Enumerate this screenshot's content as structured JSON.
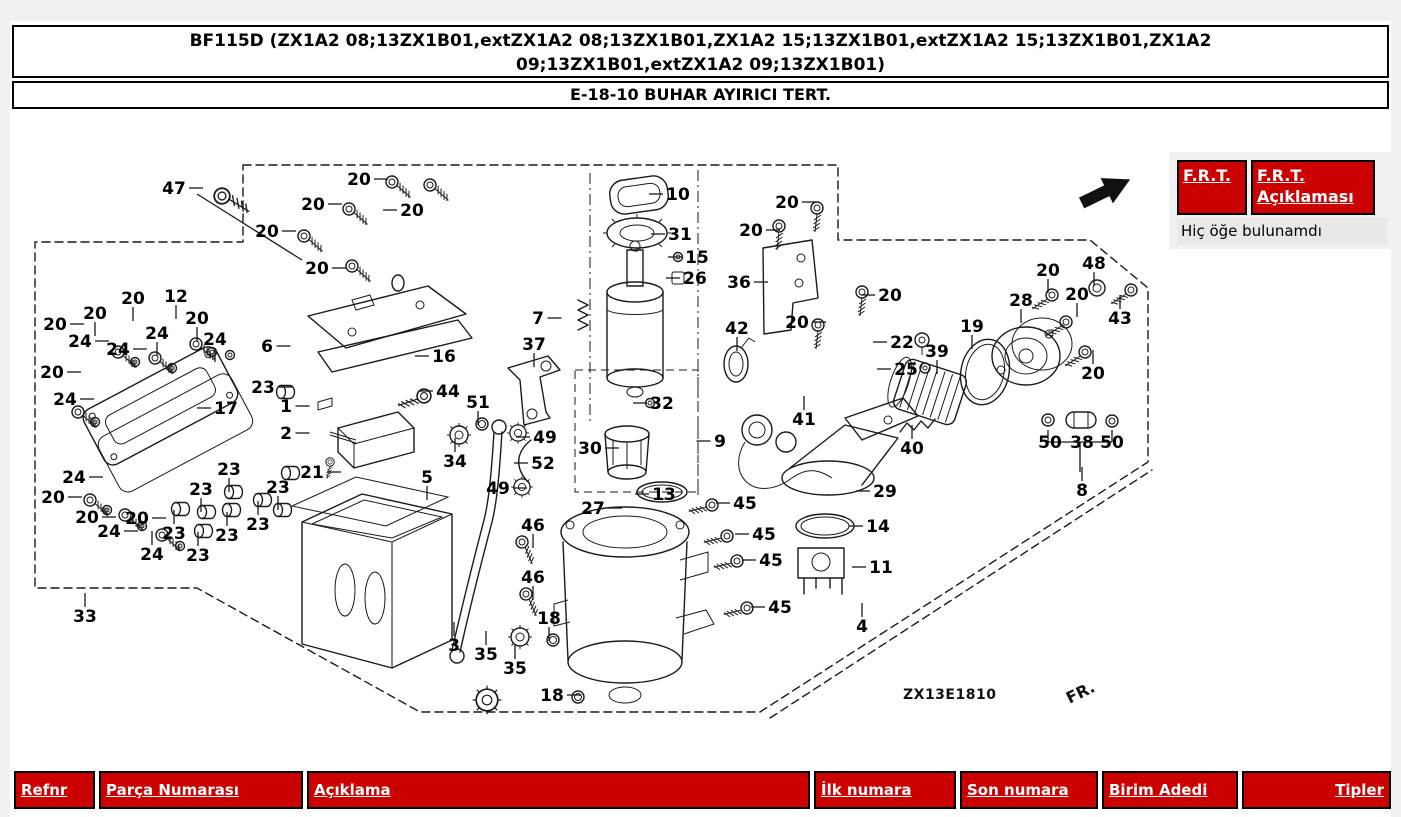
{
  "header": {
    "title_line1": "BF115D (ZX1A2 08;13ZX1B01,extZX1A2 08;13ZX1B01,ZX1A2 15;13ZX1B01,extZX1A2 15;13ZX1B01,ZX1A2",
    "title_line2": "09;13ZX1B01,extZX1A2 09;13ZX1B01)",
    "subtitle": "E-18-10 BUHAR AYIRICI TERT."
  },
  "frt": {
    "button1": "F.R.T.",
    "button2": "F.R.T. Açıklaması",
    "empty_message": "Hiç öğe bulunamdı"
  },
  "colors": {
    "accent_red": "#cc0000",
    "panel_gray": "#f1f1f1",
    "message_gray": "#e8e8e8",
    "ink": "#1a1a1a"
  },
  "diagram": {
    "figure_code": "ZX13E1810",
    "direction_label": "FR.",
    "callouts": [
      {
        "n": "47",
        "x": 174,
        "y": 188,
        "d": "r"
      },
      {
        "n": "20",
        "x": 359,
        "y": 179,
        "d": "r"
      },
      {
        "n": "20",
        "x": 313,
        "y": 204,
        "d": "r"
      },
      {
        "n": "20",
        "x": 267,
        "y": 231,
        "d": "r"
      },
      {
        "n": "20",
        "x": 317,
        "y": 268,
        "d": "r"
      },
      {
        "n": "20",
        "x": 412,
        "y": 210,
        "d": "l"
      },
      {
        "n": "12",
        "x": 176,
        "y": 296,
        "d": "d"
      },
      {
        "n": "20",
        "x": 133,
        "y": 298,
        "d": "d"
      },
      {
        "n": "20",
        "x": 95,
        "y": 313,
        "d": "d"
      },
      {
        "n": "20",
        "x": 55,
        "y": 324,
        "d": "r"
      },
      {
        "n": "24",
        "x": 80,
        "y": 341,
        "d": "r"
      },
      {
        "n": "24",
        "x": 118,
        "y": 349,
        "d": "r"
      },
      {
        "n": "24",
        "x": 157,
        "y": 333,
        "d": "d"
      },
      {
        "n": "20",
        "x": 197,
        "y": 318,
        "d": "d"
      },
      {
        "n": "24",
        "x": 215,
        "y": 339,
        "d": "d"
      },
      {
        "n": "20",
        "x": 52,
        "y": 372,
        "d": "r"
      },
      {
        "n": "24",
        "x": 65,
        "y": 399,
        "d": "r"
      },
      {
        "n": "6",
        "x": 267,
        "y": 346,
        "d": "r"
      },
      {
        "n": "16",
        "x": 444,
        "y": 356,
        "d": "l"
      },
      {
        "n": "17",
        "x": 226,
        "y": 408,
        "d": "l"
      },
      {
        "n": "23",
        "x": 263,
        "y": 387,
        "d": "r"
      },
      {
        "n": "1",
        "x": 286,
        "y": 406,
        "d": "r"
      },
      {
        "n": "2",
        "x": 286,
        "y": 433,
        "d": "r"
      },
      {
        "n": "21",
        "x": 312,
        "y": 472,
        "d": "r"
      },
      {
        "n": "33",
        "x": 85,
        "y": 616,
        "d": "u"
      },
      {
        "n": "24",
        "x": 74,
        "y": 477,
        "d": "r"
      },
      {
        "n": "20",
        "x": 53,
        "y": 497,
        "d": "r"
      },
      {
        "n": "20",
        "x": 87,
        "y": 517,
        "d": "r"
      },
      {
        "n": "24",
        "x": 109,
        "y": 531,
        "d": "r"
      },
      {
        "n": "20",
        "x": 137,
        "y": 518,
        "d": "r"
      },
      {
        "n": "24",
        "x": 152,
        "y": 554,
        "d": "u"
      },
      {
        "n": "23",
        "x": 174,
        "y": 533,
        "d": "u"
      },
      {
        "n": "23",
        "x": 201,
        "y": 489,
        "d": "d"
      },
      {
        "n": "23",
        "x": 198,
        "y": 555,
        "d": "u"
      },
      {
        "n": "23",
        "x": 229,
        "y": 469,
        "d": "d"
      },
      {
        "n": "23",
        "x": 227,
        "y": 535,
        "d": "u"
      },
      {
        "n": "23",
        "x": 258,
        "y": 524,
        "d": "u"
      },
      {
        "n": "23",
        "x": 278,
        "y": 487,
        "d": "d"
      },
      {
        "n": "44",
        "x": 448,
        "y": 391,
        "d": "l"
      },
      {
        "n": "51",
        "x": 478,
        "y": 402,
        "d": "d"
      },
      {
        "n": "34",
        "x": 455,
        "y": 461,
        "d": "u"
      },
      {
        "n": "5",
        "x": 427,
        "y": 477,
        "d": "d"
      },
      {
        "n": "3",
        "x": 454,
        "y": 645,
        "d": "u"
      },
      {
        "n": "35",
        "x": 486,
        "y": 654,
        "d": "u"
      },
      {
        "n": "35",
        "x": 515,
        "y": 668,
        "d": "u"
      },
      {
        "n": "18",
        "x": 549,
        "y": 618,
        "d": "d"
      },
      {
        "n": "18",
        "x": 552,
        "y": 695,
        "d": "r"
      },
      {
        "n": "46",
        "x": 533,
        "y": 525,
        "d": "d"
      },
      {
        "n": "46",
        "x": 533,
        "y": 577,
        "d": "d"
      },
      {
        "n": "49",
        "x": 545,
        "y": 437,
        "d": "l"
      },
      {
        "n": "52",
        "x": 543,
        "y": 463,
        "d": "l"
      },
      {
        "n": "49",
        "x": 498,
        "y": 488,
        "d": "r"
      },
      {
        "n": "37",
        "x": 534,
        "y": 344,
        "d": "d"
      },
      {
        "n": "7",
        "x": 538,
        "y": 318,
        "d": "r"
      },
      {
        "n": "10",
        "x": 678,
        "y": 194,
        "d": "l"
      },
      {
        "n": "31",
        "x": 680,
        "y": 234,
        "d": "l"
      },
      {
        "n": "15",
        "x": 697,
        "y": 257,
        "d": "l"
      },
      {
        "n": "26",
        "x": 695,
        "y": 278,
        "d": "l"
      },
      {
        "n": "32",
        "x": 662,
        "y": 403,
        "d": "l"
      },
      {
        "n": "30",
        "x": 590,
        "y": 448,
        "d": "r"
      },
      {
        "n": "13",
        "x": 664,
        "y": 494,
        "d": "l"
      },
      {
        "n": "27",
        "x": 593,
        "y": 508,
        "d": "r"
      },
      {
        "n": "9",
        "x": 720,
        "y": 441,
        "d": "l"
      },
      {
        "n": "45",
        "x": 745,
        "y": 503,
        "d": "l"
      },
      {
        "n": "45",
        "x": 764,
        "y": 534,
        "d": "l"
      },
      {
        "n": "45",
        "x": 771,
        "y": 560,
        "d": "l"
      },
      {
        "n": "45",
        "x": 780,
        "y": 607,
        "d": "l"
      },
      {
        "n": "36",
        "x": 739,
        "y": 282,
        "d": "r"
      },
      {
        "n": "20",
        "x": 787,
        "y": 202,
        "d": "r"
      },
      {
        "n": "20",
        "x": 751,
        "y": 230,
        "d": "r"
      },
      {
        "n": "20",
        "x": 797,
        "y": 322,
        "d": "r"
      },
      {
        "n": "42",
        "x": 737,
        "y": 328,
        "d": "d"
      },
      {
        "n": "41",
        "x": 804,
        "y": 419,
        "d": "u"
      },
      {
        "n": "20",
        "x": 890,
        "y": 295,
        "d": "l"
      },
      {
        "n": "22",
        "x": 902,
        "y": 342,
        "d": "l"
      },
      {
        "n": "25",
        "x": 906,
        "y": 369,
        "d": "l"
      },
      {
        "n": "39",
        "x": 937,
        "y": 351,
        "d": "d"
      },
      {
        "n": "19",
        "x": 972,
        "y": 326,
        "d": "d"
      },
      {
        "n": "28",
        "x": 1021,
        "y": 300,
        "d": "d"
      },
      {
        "n": "20",
        "x": 1048,
        "y": 270,
        "d": "d"
      },
      {
        "n": "48",
        "x": 1094,
        "y": 263,
        "d": "d"
      },
      {
        "n": "20",
        "x": 1077,
        "y": 294,
        "d": "d"
      },
      {
        "n": "43",
        "x": 1120,
        "y": 318,
        "d": "u"
      },
      {
        "n": "20",
        "x": 1093,
        "y": 373,
        "d": "u"
      },
      {
        "n": "40",
        "x": 912,
        "y": 448,
        "d": "u"
      },
      {
        "n": "29",
        "x": 885,
        "y": 491,
        "d": "l"
      },
      {
        "n": "14",
        "x": 878,
        "y": 526,
        "d": "l"
      },
      {
        "n": "11",
        "x": 881,
        "y": 567,
        "d": "l"
      },
      {
        "n": "4",
        "x": 862,
        "y": 626,
        "d": "u"
      },
      {
        "n": "50",
        "x": 1050,
        "y": 442,
        "d": ""
      },
      {
        "n": "38",
        "x": 1082,
        "y": 442,
        "d": ""
      },
      {
        "n": "50",
        "x": 1112,
        "y": 442,
        "d": ""
      },
      {
        "n": "8",
        "x": 1082,
        "y": 490,
        "d": "u"
      }
    ]
  },
  "table": {
    "columns": [
      {
        "label": "Refnr"
      },
      {
        "label": "Parça Numarası"
      },
      {
        "label": "Açıklama"
      },
      {
        "label": "İlk numara"
      },
      {
        "label": "Son numara"
      },
      {
        "label": "Birim Adedi"
      },
      {
        "label": "Tipler"
      }
    ]
  }
}
